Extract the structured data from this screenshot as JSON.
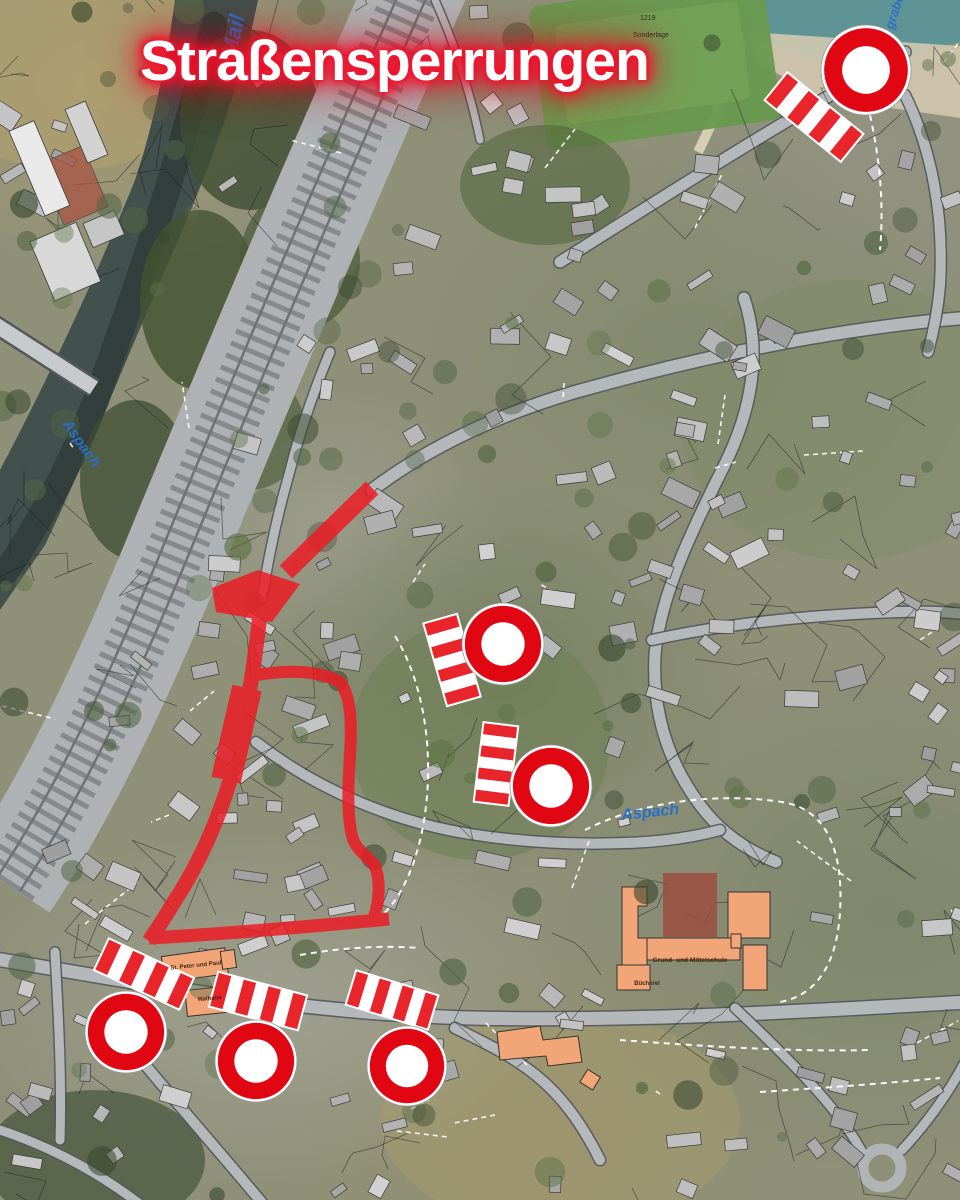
{
  "title": {
    "text": "Straßensperrungen"
  },
  "map": {
    "colors": {
      "closure_red": "#ee1b24",
      "sign_red": "#e00713",
      "barrier_red": "#e8252b",
      "stream_label_blue": "#2a70c6",
      "public_building_orange": "#f2a577"
    },
    "stream_labels": [
      {
        "text": "Mail",
        "x": 236,
        "y": 58,
        "rot": -78,
        "size": 22
      },
      {
        "text": "Aspach",
        "x": 62,
        "y": 424,
        "rot": 55,
        "size": 15
      },
      {
        "text": "Aspach",
        "x": 622,
        "y": 820,
        "rot": -6,
        "size": 16
      },
      {
        "text": "graben",
        "x": 893,
        "y": 30,
        "rot": -72,
        "size": 13
      }
    ],
    "parcel_labels": [
      {
        "text": "1219",
        "x": 640,
        "y": 20
      },
      {
        "text": "Sonderlage",
        "x": 633,
        "y": 37
      }
    ],
    "poi_labels": [
      {
        "text": "St. Peter und Paul",
        "x": 196,
        "y": 967,
        "rot": -6,
        "size": 6
      },
      {
        "text": "Rathaus",
        "x": 210,
        "y": 1000,
        "rot": -6,
        "size": 6
      },
      {
        "text": "Grund- und Mittelschule",
        "x": 690,
        "y": 962,
        "rot": 0,
        "size": 6.5
      },
      {
        "text": "Bücherei",
        "x": 647,
        "y": 985,
        "rot": 0,
        "size": 6
      }
    ],
    "no_entry_signs": [
      {
        "cx": 866,
        "cy": 70,
        "r": 45
      },
      {
        "cx": 503,
        "cy": 644,
        "r": 41
      },
      {
        "cx": 551,
        "cy": 786,
        "r": 41
      },
      {
        "cx": 126,
        "cy": 1032,
        "r": 41
      },
      {
        "cx": 256,
        "cy": 1061,
        "r": 41
      },
      {
        "cx": 407,
        "cy": 1066,
        "r": 40
      }
    ],
    "barriers": [
      {
        "cx": 814,
        "cy": 117,
        "angle": 39,
        "len": 96,
        "w": 34
      },
      {
        "cx": 452,
        "cy": 660,
        "angle": 74,
        "len": 84,
        "w": 33
      },
      {
        "cx": 496,
        "cy": 764,
        "angle": 97,
        "len": 78,
        "w": 33
      },
      {
        "cx": 144,
        "cy": 974,
        "angle": 25,
        "len": 92,
        "w": 33
      },
      {
        "cx": 258,
        "cy": 1001,
        "angle": 15,
        "len": 90,
        "w": 34
      },
      {
        "cx": 392,
        "cy": 1000,
        "angle": 17,
        "len": 84,
        "w": 34
      }
    ]
  }
}
